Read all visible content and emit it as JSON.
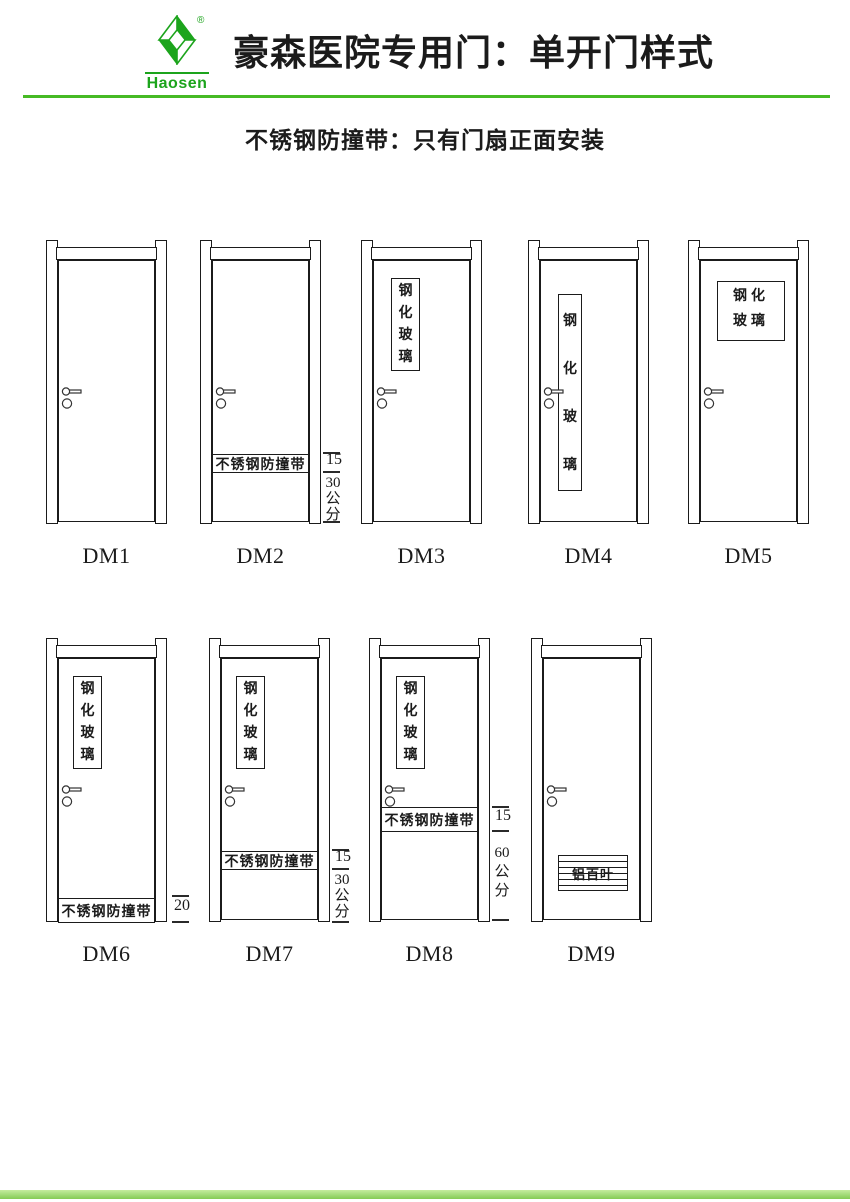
{
  "header": {
    "brand": "Haosen",
    "registered_mark": "®",
    "title": "豪森医院专用门：单开门样式",
    "subtitle": "不锈钢防撞带：只有门扇正面安装"
  },
  "colors": {
    "brand_green": "#1ca41c",
    "rule_green": "#46ba24",
    "line_ink": "#1b1b1b"
  },
  "doors": [
    {
      "label": "DM1"
    },
    {
      "label": "DM2",
      "band_label": "不锈钢防撞带",
      "dim_band": "15",
      "dim_bottom": "30公分"
    },
    {
      "label": "DM3",
      "glass_label": "钢化玻璃"
    },
    {
      "label": "DM4",
      "glass_label": "钢化玻璃"
    },
    {
      "label": "DM5",
      "glass_label": "钢化玻璃"
    },
    {
      "label": "DM6",
      "glass_label": "钢化玻璃",
      "band_label": "不锈钢防撞带",
      "dim_band": "20"
    },
    {
      "label": "DM7",
      "glass_label": "钢化玻璃",
      "band_label": "不锈钢防撞带",
      "dim_band": "15",
      "dim_bottom": "30公分"
    },
    {
      "label": "DM8",
      "glass_label": "钢化玻璃",
      "band_label": "不锈钢防撞带",
      "dim_band": "15",
      "dim_bottom": "60公分"
    },
    {
      "label": "DM9",
      "louver_label": "铝百叶"
    }
  ]
}
